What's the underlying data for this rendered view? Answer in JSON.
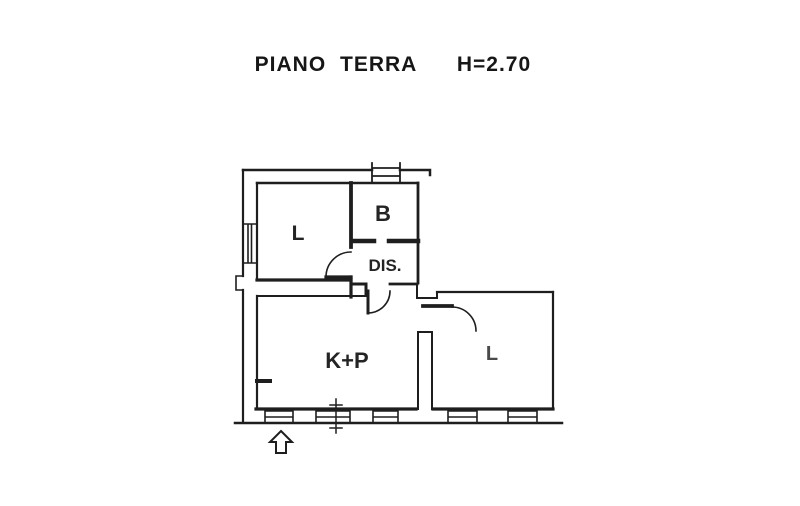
{
  "colors": {
    "background": "#ffffff",
    "ink": "#1e1e1e"
  },
  "header": {
    "title": "PIANO TERRA",
    "height_label": "H=2.70"
  },
  "plan": {
    "rooms": [
      {
        "id": "l-upper",
        "label": "L"
      },
      {
        "id": "b",
        "label": "B"
      },
      {
        "id": "dis",
        "label": "DIS."
      },
      {
        "id": "k-p",
        "label": "K+P"
      },
      {
        "id": "l-right",
        "label": "L"
      }
    ],
    "symbols": [
      {
        "name": "entrance-arrow-icon",
        "shape": "outline arrow pointing up at entrance"
      },
      {
        "name": "window-icon",
        "shape": "double-line window opening in wall"
      },
      {
        "name": "door-swing-arc",
        "shape": "quarter-circle door swing"
      },
      {
        "name": "section-cut-mark",
        "shape": "vertical cut line with tick marks"
      }
    ]
  }
}
